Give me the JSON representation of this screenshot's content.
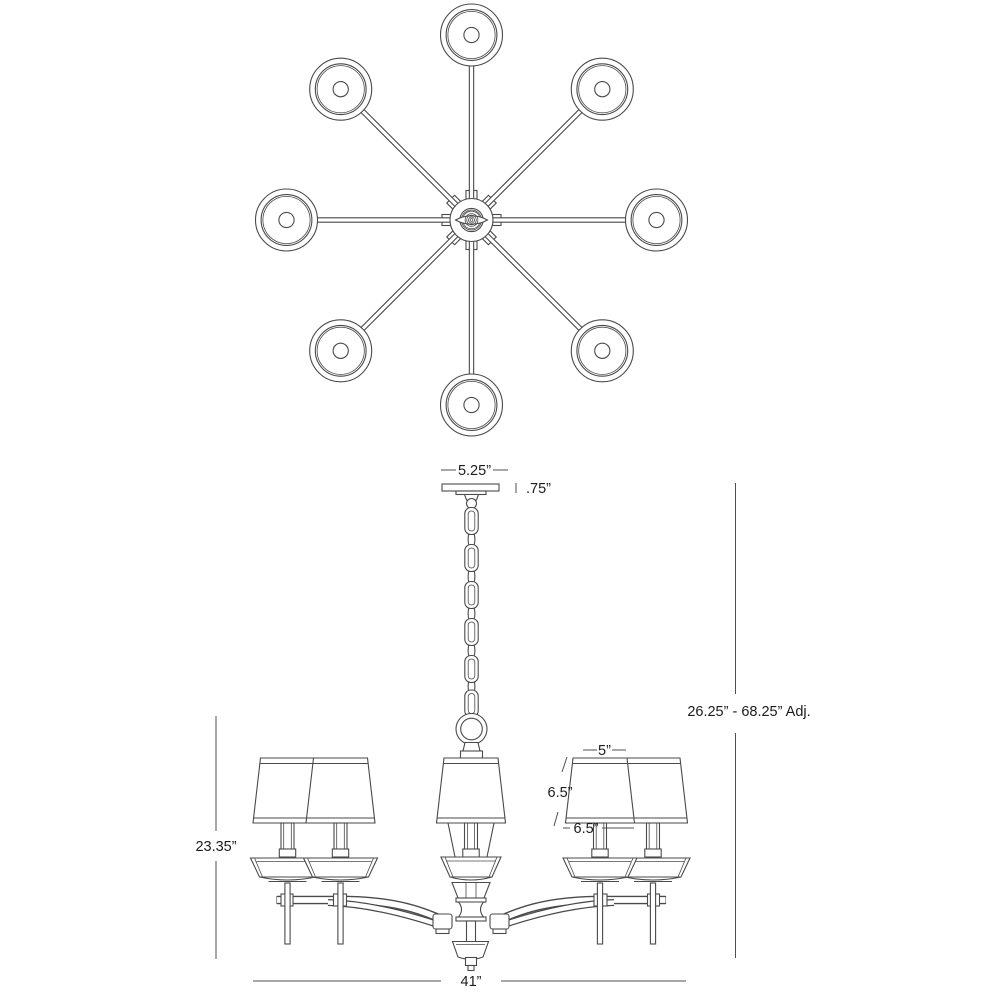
{
  "page": {
    "background": "#ffffff",
    "line_color": "#4a4a4a",
    "text_color": "#1c1c1c"
  },
  "diagram": {
    "subject": "8-arm chandelier technical specification drawing",
    "views": [
      {
        "id": "top-view",
        "description": "Plan view: 8 arms radiating from center hub, each ending in a round shade"
      },
      {
        "id": "side-view",
        "description": "Front elevation: canopy, chain, ring, center column with shades, curved arms, bottom finial"
      }
    ],
    "dimensions": {
      "canopy_width": "5.25”",
      "canopy_height": ".75”",
      "overall_height_adjustable": "26.25” - 68.25” Adj.",
      "body_height": "23.35”",
      "shade_top_diameter": "5”",
      "shade_height": "6.5”",
      "shade_bottom_diameter": "6.5”",
      "overall_width": "41”"
    }
  }
}
